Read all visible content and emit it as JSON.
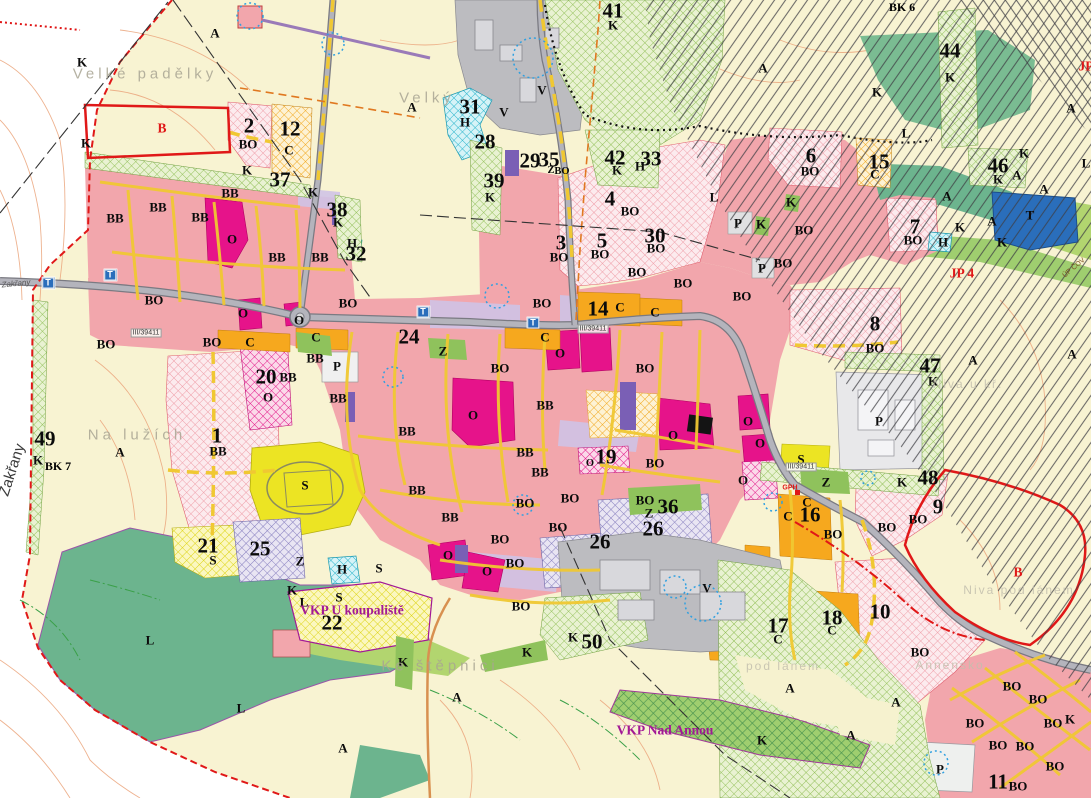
{
  "colors": {
    "background_cream": "#f8f3d2",
    "residential_pink": "#f2a6ac",
    "civic_magenta": "#e6138a",
    "commercial_orange": "#f6a81e",
    "sport_yellow": "#ece423",
    "greenery": "#8fc25c",
    "forest_teal": "#6cb48e",
    "production_gray": "#bcbcc0",
    "water_cyan": "#38c0d4",
    "technical_blue": "#2a6ebb",
    "purple_zone": "#8d85c0",
    "boundary_red": "#e01818",
    "street_yellow": "#f0c832",
    "contour_orange": "#eba57c",
    "hatch_black": "#3e3e44"
  },
  "labels": [
    {
      "t": "1",
      "x": 217,
      "y": 436,
      "k": "n"
    },
    {
      "t": "2",
      "x": 249,
      "y": 126,
      "k": "n"
    },
    {
      "t": "3",
      "x": 561,
      "y": 243,
      "k": "n"
    },
    {
      "t": "4",
      "x": 610,
      "y": 199,
      "k": "n"
    },
    {
      "t": "5",
      "x": 602,
      "y": 241,
      "k": "n"
    },
    {
      "t": "6",
      "x": 811,
      "y": 156,
      "k": "n"
    },
    {
      "t": "7",
      "x": 915,
      "y": 227,
      "k": "n"
    },
    {
      "t": "8",
      "x": 875,
      "y": 324,
      "k": "n"
    },
    {
      "t": "9",
      "x": 938,
      "y": 507,
      "k": "n"
    },
    {
      "t": "10",
      "x": 880,
      "y": 612,
      "k": "n"
    },
    {
      "t": "11",
      "x": 998,
      "y": 782,
      "k": "n"
    },
    {
      "t": "12",
      "x": 290,
      "y": 129,
      "k": "n"
    },
    {
      "t": "14",
      "x": 598,
      "y": 309,
      "k": "n"
    },
    {
      "t": "15",
      "x": 879,
      "y": 162,
      "k": "n"
    },
    {
      "t": "16",
      "x": 810,
      "y": 515,
      "k": "n"
    },
    {
      "t": "17",
      "x": 778,
      "y": 626,
      "k": "n"
    },
    {
      "t": "18",
      "x": 832,
      "y": 618,
      "k": "n"
    },
    {
      "t": "19",
      "x": 606,
      "y": 457,
      "k": "n"
    },
    {
      "t": "20",
      "x": 266,
      "y": 377,
      "k": "n"
    },
    {
      "t": "21",
      "x": 208,
      "y": 546,
      "k": "n"
    },
    {
      "t": "22",
      "x": 332,
      "y": 623,
      "k": "n"
    },
    {
      "t": "24",
      "x": 409,
      "y": 337,
      "k": "n"
    },
    {
      "t": "25",
      "x": 260,
      "y": 549,
      "k": "n"
    },
    {
      "t": "26",
      "x": 600,
      "y": 542,
      "k": "n"
    },
    {
      "t": "26",
      "x": 653,
      "y": 529,
      "k": "n"
    },
    {
      "t": "28",
      "x": 485,
      "y": 142,
      "k": "n"
    },
    {
      "t": "29",
      "x": 530,
      "y": 161,
      "k": "n"
    },
    {
      "t": "30",
      "x": 655,
      "y": 236,
      "k": "n"
    },
    {
      "t": "31",
      "x": 470,
      "y": 107,
      "k": "n"
    },
    {
      "t": "32",
      "x": 356,
      "y": 254,
      "k": "n"
    },
    {
      "t": "33",
      "x": 651,
      "y": 159,
      "k": "n"
    },
    {
      "t": "35",
      "x": 549,
      "y": 160,
      "k": "n"
    },
    {
      "t": "36",
      "x": 668,
      "y": 507,
      "k": "n"
    },
    {
      "t": "37",
      "x": 280,
      "y": 180,
      "k": "n"
    },
    {
      "t": "38",
      "x": 337,
      "y": 210,
      "k": "n"
    },
    {
      "t": "39",
      "x": 494,
      "y": 181,
      "k": "n"
    },
    {
      "t": "41",
      "x": 613,
      "y": 11,
      "k": "n"
    },
    {
      "t": "42",
      "x": 615,
      "y": 158,
      "k": "n"
    },
    {
      "t": "44",
      "x": 950,
      "y": 51,
      "k": "n"
    },
    {
      "t": "46",
      "x": 998,
      "y": 166,
      "k": "n"
    },
    {
      "t": "47",
      "x": 930,
      "y": 366,
      "k": "n"
    },
    {
      "t": "48",
      "x": 928,
      "y": 478,
      "k": "n"
    },
    {
      "t": "49",
      "x": 45,
      "y": 439,
      "k": "n"
    },
    {
      "t": "50",
      "x": 592,
      "y": 642,
      "k": "n"
    },
    {
      "t": "A",
      "x": 215,
      "y": 33,
      "k": "c"
    },
    {
      "t": "A",
      "x": 412,
      "y": 107,
      "k": "c"
    },
    {
      "t": "A",
      "x": 120,
      "y": 452,
      "k": "c"
    },
    {
      "t": "A",
      "x": 457,
      "y": 697,
      "k": "c"
    },
    {
      "t": "A",
      "x": 343,
      "y": 748,
      "k": "c"
    },
    {
      "t": "A",
      "x": 763,
      "y": 68,
      "k": "c"
    },
    {
      "t": "A",
      "x": 947,
      "y": 196,
      "k": "c"
    },
    {
      "t": "A",
      "x": 992,
      "y": 221,
      "k": "c"
    },
    {
      "t": "A",
      "x": 1017,
      "y": 175,
      "k": "c"
    },
    {
      "t": "A",
      "x": 1044,
      "y": 189,
      "k": "c"
    },
    {
      "t": "A",
      "x": 1071,
      "y": 108,
      "k": "c"
    },
    {
      "t": "A",
      "x": 1072,
      "y": 354,
      "k": "c"
    },
    {
      "t": "A",
      "x": 973,
      "y": 360,
      "k": "c"
    },
    {
      "t": "A",
      "x": 790,
      "y": 688,
      "k": "c"
    },
    {
      "t": "A",
      "x": 896,
      "y": 702,
      "k": "c"
    },
    {
      "t": "A",
      "x": 851,
      "y": 735,
      "k": "c"
    },
    {
      "t": "K",
      "x": 82,
      "y": 62,
      "k": "c"
    },
    {
      "t": "K",
      "x": 86,
      "y": 143,
      "k": "c"
    },
    {
      "t": "K",
      "x": 247,
      "y": 170,
      "k": "c"
    },
    {
      "t": "K",
      "x": 313,
      "y": 192,
      "k": "c"
    },
    {
      "t": "K",
      "x": 338,
      "y": 222,
      "k": "c"
    },
    {
      "t": "K",
      "x": 490,
      "y": 197,
      "k": "c"
    },
    {
      "t": "K",
      "x": 613,
      "y": 25,
      "k": "c"
    },
    {
      "t": "K",
      "x": 617,
      "y": 170,
      "k": "c"
    },
    {
      "t": "K",
      "x": 761,
      "y": 224,
      "k": "c"
    },
    {
      "t": "K",
      "x": 791,
      "y": 202,
      "k": "c"
    },
    {
      "t": "K",
      "x": 877,
      "y": 92,
      "k": "c"
    },
    {
      "t": "K",
      "x": 950,
      "y": 77,
      "k": "c"
    },
    {
      "t": "K",
      "x": 960,
      "y": 227,
      "k": "c"
    },
    {
      "t": "K",
      "x": 998,
      "y": 179,
      "k": "c"
    },
    {
      "t": "K",
      "x": 1002,
      "y": 242,
      "k": "c"
    },
    {
      "t": "K",
      "x": 1024,
      "y": 153,
      "k": "c"
    },
    {
      "t": "K",
      "x": 933,
      "y": 381,
      "k": "c"
    },
    {
      "t": "K",
      "x": 902,
      "y": 482,
      "k": "c"
    },
    {
      "t": "K",
      "x": 38,
      "y": 460,
      "k": "c"
    },
    {
      "t": "K",
      "x": 292,
      "y": 590,
      "k": "c"
    },
    {
      "t": "K",
      "x": 403,
      "y": 662,
      "k": "c"
    },
    {
      "t": "K",
      "x": 527,
      "y": 652,
      "k": "c"
    },
    {
      "t": "K",
      "x": 573,
      "y": 637,
      "k": "c"
    },
    {
      "t": "K",
      "x": 762,
      "y": 740,
      "k": "c"
    },
    {
      "t": "K",
      "x": 1070,
      "y": 719,
      "k": "c"
    },
    {
      "t": "BO",
      "x": 248,
      "y": 144,
      "k": "c"
    },
    {
      "t": "BO",
      "x": 154,
      "y": 300,
      "k": "c"
    },
    {
      "t": "BO",
      "x": 106,
      "y": 344,
      "k": "c"
    },
    {
      "t": "BO",
      "x": 212,
      "y": 342,
      "k": "c"
    },
    {
      "t": "BO",
      "x": 348,
      "y": 303,
      "k": "c"
    },
    {
      "t": "BO",
      "x": 542,
      "y": 303,
      "k": "c"
    },
    {
      "t": "BO",
      "x": 500,
      "y": 368,
      "k": "c"
    },
    {
      "t": "BO",
      "x": 525,
      "y": 503,
      "k": "c"
    },
    {
      "t": "BO",
      "x": 570,
      "y": 498,
      "k": "c"
    },
    {
      "t": "BO",
      "x": 558,
      "y": 527,
      "k": "c"
    },
    {
      "t": "BO",
      "x": 559,
      "y": 257,
      "k": "c"
    },
    {
      "t": "BO",
      "x": 600,
      "y": 254,
      "k": "c"
    },
    {
      "t": "BO",
      "x": 630,
      "y": 211,
      "k": "c"
    },
    {
      "t": "BO",
      "x": 637,
      "y": 272,
      "k": "c"
    },
    {
      "t": "BO",
      "x": 656,
      "y": 248,
      "k": "c"
    },
    {
      "t": "BO",
      "x": 683,
      "y": 283,
      "k": "c"
    },
    {
      "t": "BO",
      "x": 645,
      "y": 368,
      "k": "c"
    },
    {
      "t": "BO",
      "x": 655,
      "y": 463,
      "k": "c"
    },
    {
      "t": "BO",
      "x": 645,
      "y": 500,
      "k": "c"
    },
    {
      "t": "BO",
      "x": 810,
      "y": 171,
      "k": "c"
    },
    {
      "t": "BO",
      "x": 913,
      "y": 240,
      "k": "c"
    },
    {
      "t": "BO",
      "x": 875,
      "y": 348,
      "k": "c"
    },
    {
      "t": "BO",
      "x": 918,
      "y": 519,
      "k": "c"
    },
    {
      "t": "BO",
      "x": 920,
      "y": 652,
      "k": "c"
    },
    {
      "t": "BO",
      "x": 742,
      "y": 296,
      "k": "c"
    },
    {
      "t": "BO",
      "x": 783,
      "y": 263,
      "k": "c"
    },
    {
      "t": "BO",
      "x": 804,
      "y": 230,
      "k": "c"
    },
    {
      "t": "BO",
      "x": 833,
      "y": 534,
      "k": "c"
    },
    {
      "t": "BO",
      "x": 887,
      "y": 527,
      "k": "c"
    },
    {
      "t": "BO",
      "x": 500,
      "y": 539,
      "k": "c"
    },
    {
      "t": "BO",
      "x": 515,
      "y": 563,
      "k": "c"
    },
    {
      "t": "BO",
      "x": 521,
      "y": 606,
      "k": "c"
    },
    {
      "t": "BO",
      "x": 1012,
      "y": 686,
      "k": "c"
    },
    {
      "t": "BO",
      "x": 1038,
      "y": 699,
      "k": "c"
    },
    {
      "t": "BO",
      "x": 975,
      "y": 723,
      "k": "c"
    },
    {
      "t": "BO",
      "x": 1053,
      "y": 723,
      "k": "c"
    },
    {
      "t": "BO",
      "x": 998,
      "y": 745,
      "k": "c"
    },
    {
      "t": "BO",
      "x": 1025,
      "y": 746,
      "k": "c"
    },
    {
      "t": "BO",
      "x": 1055,
      "y": 766,
      "k": "c"
    },
    {
      "t": "BO",
      "x": 1018,
      "y": 786,
      "k": "c"
    },
    {
      "t": "BO",
      "x": 562,
      "y": 172,
      "k": "sm"
    },
    {
      "t": "BB",
      "x": 115,
      "y": 218,
      "k": "c"
    },
    {
      "t": "BB",
      "x": 158,
      "y": 207,
      "k": "c"
    },
    {
      "t": "BB",
      "x": 200,
      "y": 217,
      "k": "c"
    },
    {
      "t": "BB",
      "x": 230,
      "y": 193,
      "k": "c"
    },
    {
      "t": "BB",
      "x": 277,
      "y": 257,
      "k": "c"
    },
    {
      "t": "BB",
      "x": 320,
      "y": 257,
      "k": "c"
    },
    {
      "t": "BB",
      "x": 315,
      "y": 358,
      "k": "c"
    },
    {
      "t": "BB",
      "x": 288,
      "y": 377,
      "k": "c"
    },
    {
      "t": "BB",
      "x": 338,
      "y": 398,
      "k": "c"
    },
    {
      "t": "BB",
      "x": 407,
      "y": 431,
      "k": "c"
    },
    {
      "t": "BB",
      "x": 525,
      "y": 452,
      "k": "c"
    },
    {
      "t": "BB",
      "x": 540,
      "y": 472,
      "k": "c"
    },
    {
      "t": "BB",
      "x": 417,
      "y": 490,
      "k": "c"
    },
    {
      "t": "BB",
      "x": 450,
      "y": 517,
      "k": "c"
    },
    {
      "t": "BB",
      "x": 545,
      "y": 405,
      "k": "c"
    },
    {
      "t": "BB",
      "x": 218,
      "y": 451,
      "k": "c"
    },
    {
      "t": "O",
      "x": 232,
      "y": 239,
      "k": "c"
    },
    {
      "t": "O",
      "x": 243,
      "y": 313,
      "k": "c"
    },
    {
      "t": "O",
      "x": 299,
      "y": 320,
      "k": "c"
    },
    {
      "t": "O",
      "x": 268,
      "y": 397,
      "k": "c"
    },
    {
      "t": "O",
      "x": 473,
      "y": 415,
      "k": "c"
    },
    {
      "t": "O",
      "x": 560,
      "y": 353,
      "k": "c"
    },
    {
      "t": "O",
      "x": 673,
      "y": 435,
      "k": "c"
    },
    {
      "t": "O",
      "x": 748,
      "y": 421,
      "k": "c"
    },
    {
      "t": "O",
      "x": 760,
      "y": 443,
      "k": "c"
    },
    {
      "t": "O",
      "x": 743,
      "y": 480,
      "k": "c"
    },
    {
      "t": "O",
      "x": 448,
      "y": 555,
      "k": "c"
    },
    {
      "t": "O",
      "x": 487,
      "y": 571,
      "k": "c"
    },
    {
      "t": "O",
      "x": 590,
      "y": 464,
      "k": "sm"
    },
    {
      "t": "C",
      "x": 289,
      "y": 150,
      "k": "c"
    },
    {
      "t": "C",
      "x": 250,
      "y": 342,
      "k": "c"
    },
    {
      "t": "C",
      "x": 316,
      "y": 337,
      "k": "c"
    },
    {
      "t": "C",
      "x": 545,
      "y": 337,
      "k": "c"
    },
    {
      "t": "C",
      "x": 620,
      "y": 307,
      "k": "c"
    },
    {
      "t": "C",
      "x": 655,
      "y": 312,
      "k": "c"
    },
    {
      "t": "C",
      "x": 875,
      "y": 174,
      "k": "c"
    },
    {
      "t": "C",
      "x": 807,
      "y": 502,
      "k": "c"
    },
    {
      "t": "C",
      "x": 788,
      "y": 516,
      "k": "c"
    },
    {
      "t": "C",
      "x": 778,
      "y": 639,
      "k": "c"
    },
    {
      "t": "C",
      "x": 832,
      "y": 630,
      "k": "c"
    },
    {
      "t": "S",
      "x": 305,
      "y": 485,
      "k": "c"
    },
    {
      "t": "S",
      "x": 213,
      "y": 560,
      "k": "c"
    },
    {
      "t": "S",
      "x": 379,
      "y": 568,
      "k": "c"
    },
    {
      "t": "S",
      "x": 339,
      "y": 597,
      "k": "c"
    },
    {
      "t": "S",
      "x": 801,
      "y": 459,
      "k": "c"
    },
    {
      "t": "P",
      "x": 337,
      "y": 366,
      "k": "c"
    },
    {
      "t": "P",
      "x": 738,
      "y": 223,
      "k": "c"
    },
    {
      "t": "P",
      "x": 762,
      "y": 268,
      "k": "c"
    },
    {
      "t": "P",
      "x": 879,
      "y": 421,
      "k": "c"
    },
    {
      "t": "P",
      "x": 940,
      "y": 769,
      "k": "c"
    },
    {
      "t": "V",
      "x": 504,
      "y": 112,
      "k": "c"
    },
    {
      "t": "V",
      "x": 542,
      "y": 90,
      "k": "c"
    },
    {
      "t": "V",
      "x": 707,
      "y": 588,
      "k": "c"
    },
    {
      "t": "T",
      "x": 1030,
      "y": 215,
      "k": "c"
    },
    {
      "t": "T",
      "x": 48,
      "y": 283,
      "k": "tbox"
    },
    {
      "t": "T",
      "x": 110,
      "y": 275,
      "k": "tbox"
    },
    {
      "t": "T",
      "x": 423,
      "y": 312,
      "k": "tbox"
    },
    {
      "t": "T",
      "x": 533,
      "y": 323,
      "k": "tbox"
    },
    {
      "t": "H",
      "x": 465,
      "y": 122,
      "k": "c"
    },
    {
      "t": "H",
      "x": 352,
      "y": 243,
      "k": "c"
    },
    {
      "t": "H",
      "x": 640,
      "y": 166,
      "k": "c"
    },
    {
      "t": "H",
      "x": 943,
      "y": 242,
      "k": "c"
    },
    {
      "t": "H",
      "x": 342,
      "y": 569,
      "k": "c"
    },
    {
      "t": "L",
      "x": 150,
      "y": 640,
      "k": "c"
    },
    {
      "t": "L",
      "x": 241,
      "y": 708,
      "k": "c"
    },
    {
      "t": "L",
      "x": 304,
      "y": 602,
      "k": "c"
    },
    {
      "t": "L",
      "x": 906,
      "y": 133,
      "k": "c"
    },
    {
      "t": "L",
      "x": 714,
      "y": 197,
      "k": "c"
    },
    {
      "t": "L",
      "x": 1086,
      "y": 163,
      "k": "c"
    },
    {
      "t": "Z",
      "x": 300,
      "y": 561,
      "k": "c"
    },
    {
      "t": "Z",
      "x": 649,
      "y": 513,
      "k": "c"
    },
    {
      "t": "Z",
      "x": 826,
      "y": 482,
      "k": "c"
    },
    {
      "t": "Z",
      "x": 443,
      "y": 351,
      "k": "c"
    },
    {
      "t": "Z",
      "x": 551,
      "y": 171,
      "k": "sm"
    },
    {
      "t": "Velké padělky",
      "x": 145,
      "y": 74,
      "k": "p"
    },
    {
      "t": "Velký",
      "x": 427,
      "y": 98,
      "k": "p"
    },
    {
      "t": "Na lužích",
      "x": 137,
      "y": 435,
      "k": "p"
    },
    {
      "t": "Ke štěpnici",
      "x": 440,
      "y": 666,
      "k": "p"
    },
    {
      "t": "Niva pod lánem",
      "x": 1019,
      "y": 590,
      "k": "p2"
    },
    {
      "t": "Niva u kř.",
      "x": 968,
      "y": 384,
      "k": "p2"
    },
    {
      "t": "pod lánem",
      "x": 783,
      "y": 666,
      "k": "p2"
    },
    {
      "t": "Annensko",
      "x": 950,
      "y": 665,
      "k": "p2"
    },
    {
      "t": "VKP U koupaliště",
      "x": 352,
      "y": 610,
      "k": "vkp"
    },
    {
      "t": "VKP Nad Annou",
      "x": 665,
      "y": 730,
      "k": "vkp"
    },
    {
      "t": "B",
      "x": 162,
      "y": 128,
      "k": "red"
    },
    {
      "t": "B",
      "x": 1018,
      "y": 572,
      "k": "red"
    },
    {
      "t": "JP 4",
      "x": 962,
      "y": 273,
      "k": "red"
    },
    {
      "t": "JP",
      "x": 1086,
      "y": 66,
      "k": "red"
    },
    {
      "t": "GPH",
      "x": 790,
      "y": 488,
      "k": "rt"
    },
    {
      "t": "BK 6",
      "x": 902,
      "y": 7,
      "k": "bk"
    },
    {
      "t": "BK 7",
      "x": 58,
      "y": 466,
      "k": "bk"
    },
    {
      "t": "III/39411",
      "x": 146,
      "y": 333,
      "k": "ref"
    },
    {
      "t": "III/39411",
      "x": 593,
      "y": 329,
      "k": "ref"
    },
    {
      "t": "III/39411",
      "x": 801,
      "y": 467,
      "k": "ref"
    },
    {
      "t": "Zakřany",
      "x": 12,
      "y": 470,
      "k": "e",
      "r": -72
    },
    {
      "t": "Zakřany",
      "x": 16,
      "y": 284,
      "k": "ti",
      "r": -6
    },
    {
      "t": "ÚP ČOV",
      "x": 1074,
      "y": 268,
      "k": "br",
      "r": -40
    }
  ]
}
